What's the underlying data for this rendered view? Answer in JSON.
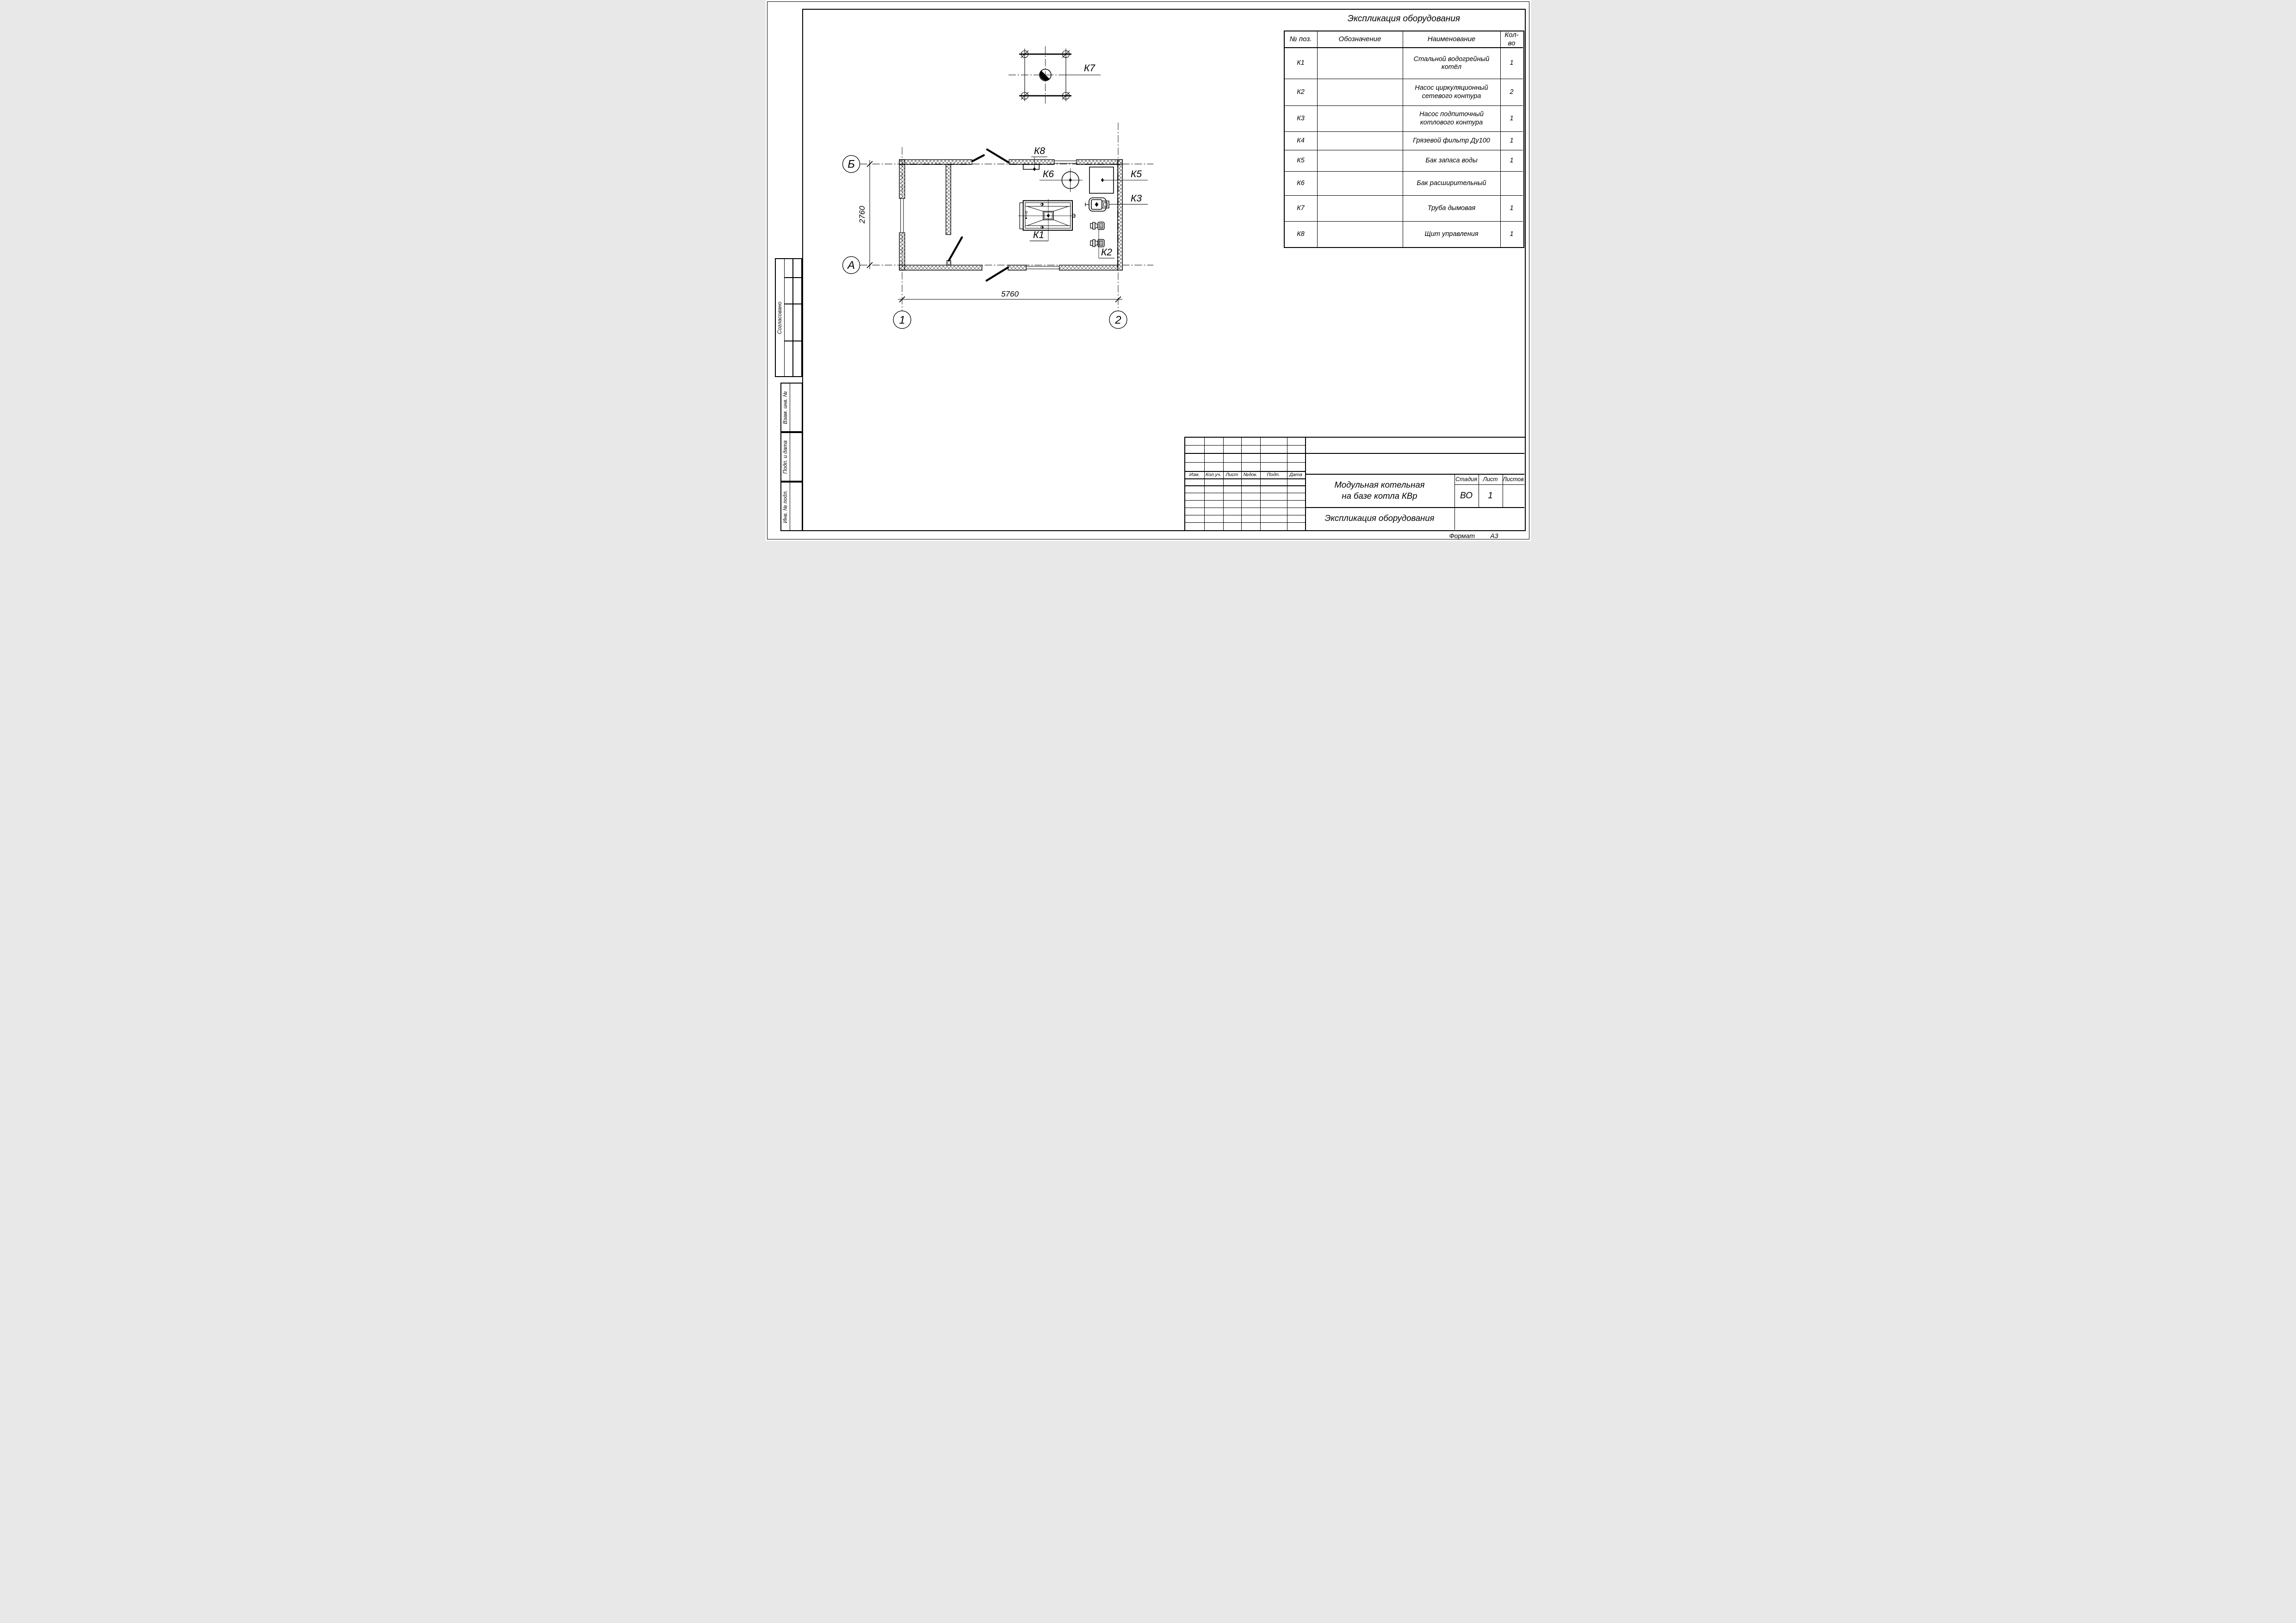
{
  "equipment_table": {
    "title": "Экспликация оборудования",
    "headers": {
      "pos": "№ поз.",
      "designation": "Обозначение",
      "name": "Наименование",
      "qty": "Кол-во"
    },
    "rows": [
      {
        "pos": "К1",
        "designation": "",
        "name": "Стальной водогрейный котёл",
        "qty": "1"
      },
      {
        "pos": "К2",
        "designation": "",
        "name": "Насос циркуляционный сетевого контура",
        "qty": "2"
      },
      {
        "pos": "К3",
        "designation": "",
        "name": "Насос подпиточный котлового контура",
        "qty": "1"
      },
      {
        "pos": "К4",
        "designation": "",
        "name": "Грязевой фильтр Ду100",
        "qty": "1"
      },
      {
        "pos": "К5",
        "designation": "",
        "name": "Бак запаса воды",
        "qty": "1"
      },
      {
        "pos": "К6",
        "designation": "",
        "name": "Бак расширительный",
        "qty": ""
      },
      {
        "pos": "К7",
        "designation": "",
        "name": "Труба дымовая",
        "qty": "1"
      },
      {
        "pos": "К8",
        "designation": "",
        "name": "Щит управления",
        "qty": "1"
      }
    ]
  },
  "plan": {
    "axis": {
      "b": "Б",
      "a": "А",
      "one": "1",
      "two": "2"
    },
    "dimensions": {
      "width": "5760",
      "height": "2760"
    },
    "labels": {
      "k1": "К1",
      "k2": "К2",
      "k3": "К3",
      "k5": "К5",
      "k6": "К6",
      "k7": "К7",
      "k8": "К8"
    }
  },
  "title_block": {
    "project_title_line1": "Модульная котельная",
    "project_title_line2": "на базе котла КВр",
    "sheet_title": "Экспликация оборудования",
    "stage_label": "Стадия",
    "sheet_label": "Лист",
    "sheets_label": "Листов",
    "stage_value": "ВО",
    "sheet_value": "1",
    "sheets_value": "",
    "rev_headers": [
      "Изм.",
      "Кол.уч.",
      "Лист",
      "№док.",
      "Подп.",
      "Дата"
    ]
  },
  "side_stamps": {
    "agreed": "Согласовано",
    "replace_inv": "Взам. инв. №",
    "sign_date": "Подп. и дата",
    "inv_number": "Инв. № подл."
  },
  "footer": {
    "format_label": "Формат",
    "format_value": "А3"
  }
}
